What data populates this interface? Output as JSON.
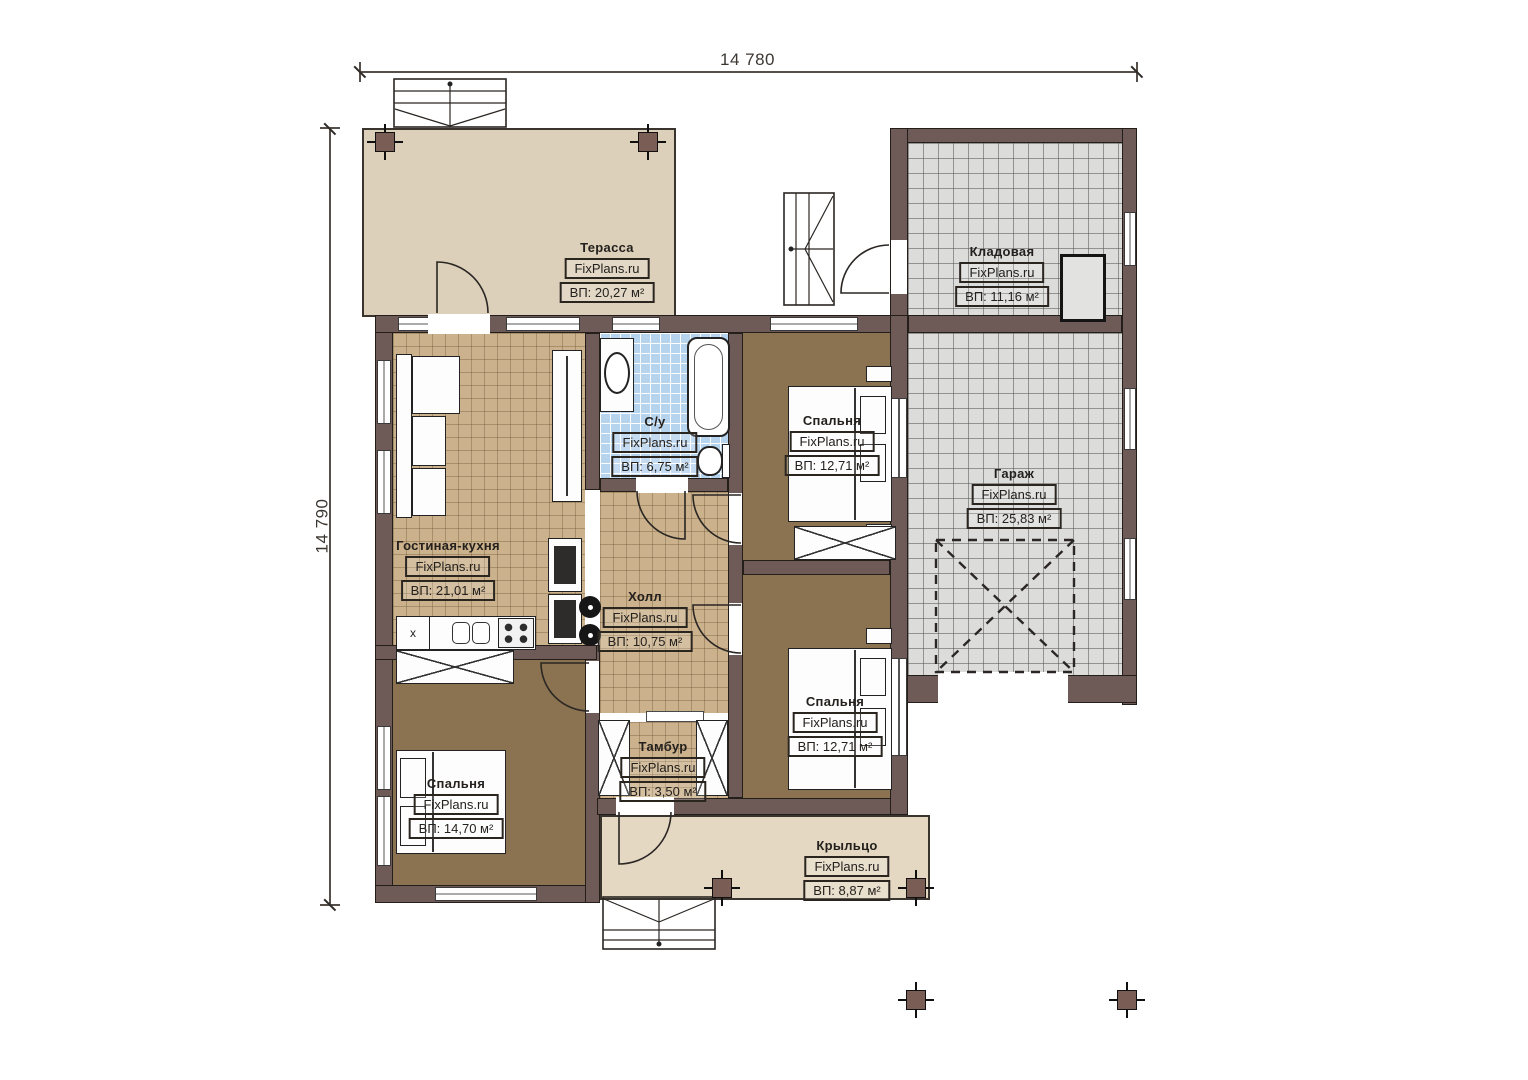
{
  "plan": {
    "dimensions": {
      "width_label": "14 780",
      "height_label": "14 790"
    },
    "brand": "FixPlans.ru",
    "rooms": [
      {
        "key": "terrace",
        "name": "Терасса",
        "brand": "FixPlans.ru",
        "area": "ВП: 20,27 м²"
      },
      {
        "key": "storage",
        "name": "Кладовая",
        "brand": "FixPlans.ru",
        "area": "ВП: 11,16 м²"
      },
      {
        "key": "bedroom-top",
        "name": "Спальня",
        "brand": "FixPlans.ru",
        "area": "ВП: 12,71 м²"
      },
      {
        "key": "garage",
        "name": "Гараж",
        "brand": "FixPlans.ru",
        "area": "ВП: 25,83 м²"
      },
      {
        "key": "bathroom",
        "name": "С/у",
        "brand": "FixPlans.ru",
        "area": "ВП: 6,75 м²"
      },
      {
        "key": "living-kitchen",
        "name": "Гостиная-кухня",
        "brand": "FixPlans.ru",
        "area": "ВП: 21,01 м²"
      },
      {
        "key": "hall",
        "name": "Холл",
        "brand": "FixPlans.ru",
        "area": "ВП: 10,75 м²"
      },
      {
        "key": "bedroom-right",
        "name": "Спальня",
        "brand": "FixPlans.ru",
        "area": "ВП: 12,71 м²"
      },
      {
        "key": "tambour",
        "name": "Тамбур",
        "brand": "FixPlans.ru",
        "area": "ВП: 3,50 м²"
      },
      {
        "key": "bedroom-bottom",
        "name": "Спальня",
        "brand": "FixPlans.ru",
        "area": "ВП: 14,70 м²"
      },
      {
        "key": "porch",
        "name": "Крыльцо",
        "brand": "FixPlans.ru",
        "area": "ВП: 8,87 м²"
      }
    ],
    "kitchen": {
      "cabinet_mark": "x"
    },
    "colors": {
      "wall": "#6e5b57",
      "terrace_floor": "#ddd0ba",
      "porch_floor": "#e4d8c3",
      "tile_tan": "#cbb18c",
      "tile_blue": "#b7d4ee",
      "tile_gray": "#dcdcda",
      "bedroom_floor": "#8b7351"
    }
  }
}
